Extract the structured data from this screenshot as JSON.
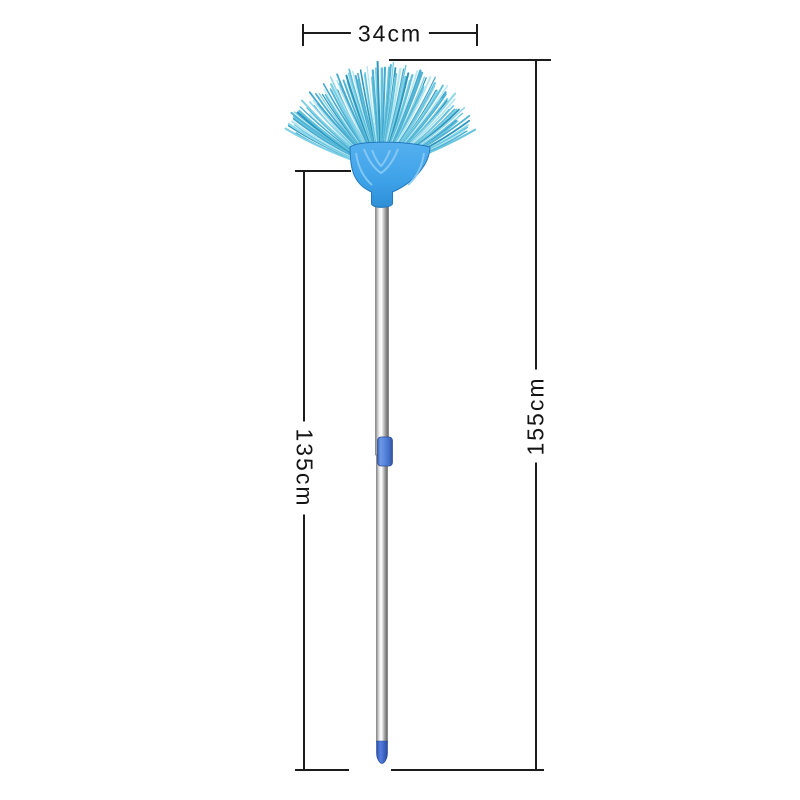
{
  "figure": {
    "type": "product dimension diagram",
    "product": "fan-shaped ceiling duster broom with telescopic handle",
    "background": "#ffffff"
  },
  "annotations": {
    "head_width": {
      "label": "34cm"
    },
    "handle_length": {
      "label": "135cm"
    },
    "total_length": {
      "label": "155cm"
    },
    "line_color": "#1c1c1c",
    "text_color": "#141414"
  },
  "colors": {
    "bristles": [
      "#4fb3d4",
      "#7ed0e6",
      "#2f96bd",
      "#8ed8ea",
      "#5fc1dc",
      "#b4e6f2",
      "#45a9cf",
      "#69c5de"
    ],
    "holder": "#3ea2e8",
    "holder_highlight": "#8ccdf6",
    "holder_edge": "#2379bd",
    "collar": "#5585dd",
    "tip": "#3c63c0",
    "pole_highlight": "#ffffff",
    "pole_shadow": "#636363"
  }
}
